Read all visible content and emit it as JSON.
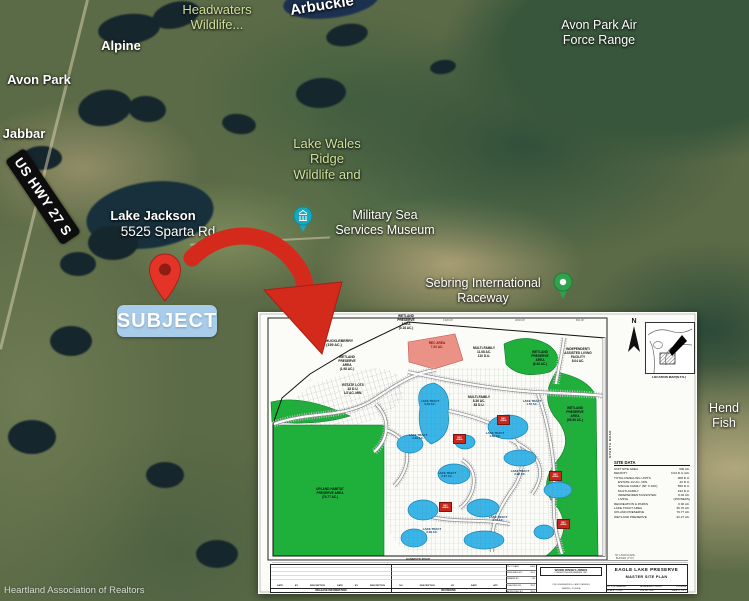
{
  "colors": {
    "arrow_red": "#d32a1c",
    "subject_badge_blue": "#a8cdeb",
    "preserve_green": "#1fb03c",
    "lake_blue": "#3ab5e8",
    "rec_salmon": "#eb9286",
    "museum_pin_teal": "#15aabf",
    "raceway_pin_green": "#2fa34c"
  },
  "map": {
    "subject_label": "SUBJECT",
    "highway_label": "US HWY 27 S",
    "watermark": "Heartland Association of Realtors",
    "labels": [
      {
        "text": "Headwaters\nWildlife...",
        "x": 217,
        "y": 2,
        "cls": "park"
      },
      {
        "text": "Alpine",
        "x": 121,
        "y": 38,
        "cls": "b"
      },
      {
        "text": "Avon Park",
        "x": 39,
        "y": 72,
        "cls": "b"
      },
      {
        "text": "Arbuckle",
        "x": 322,
        "y": -3,
        "cls": "big arb"
      },
      {
        "text": "Avon Park Air\nForce Range",
        "x": 599,
        "y": 18,
        "cls": ""
      },
      {
        "text": "Jabbar",
        "x": 24,
        "y": 126,
        "cls": "b"
      },
      {
        "text": "Lake Wales\nRidge\nWildlife and",
        "x": 327,
        "y": 136,
        "cls": "park"
      },
      {
        "text": "Military Sea\nServices Museum",
        "x": 385,
        "y": 208,
        "cls": ""
      },
      {
        "text": "Sebring International\nRaceway",
        "x": 483,
        "y": 276,
        "cls": ""
      },
      {
        "text": "Lake Jackson",
        "x": 153,
        "y": 208,
        "cls": "b"
      },
      {
        "text": "5525 Sparta Rd",
        "x": 168,
        "y": 224,
        "cls": "lg"
      },
      {
        "text": "Hend\nFish",
        "x": 724,
        "y": 401,
        "cls": ""
      }
    ]
  },
  "plan": {
    "north_label": "N",
    "location_map_caption": "LOCATION MAP(N.T.S.)",
    "sparta_road_label": "SPARTA ROAD",
    "hammock_road_label": "HAMMOCK ROAD",
    "parcel_labels": [
      {
        "text": "WETLAND\nPRESERVE\nAREA\n(0.18 AC.)",
        "x": 148,
        "y": 2,
        "cls": ""
      },
      {
        "text": "LAKE HUCKLEBERRY\n(159 AC.)",
        "x": 76,
        "y": 27,
        "cls": "bg"
      },
      {
        "text": "REC AREA\n7.20 AC.",
        "x": 179,
        "y": 29,
        "cls": "red"
      },
      {
        "text": "MULTI-FAMILY\n11.08 AC.\n110 D.U.",
        "x": 226,
        "y": 34,
        "cls": ""
      },
      {
        "text": "WETLAND\nPRESERVE\nAREA\n(6.36 AC.)",
        "x": 282,
        "y": 38,
        "cls": ""
      },
      {
        "text": "INDEPENDENT/\nASSISTED LIVING\nFACILITY\n8.04 AC.",
        "x": 320,
        "y": 35,
        "cls": ""
      },
      {
        "text": "WETLAND\nPRESERVE\nAREA\n(1.98 AC.)",
        "x": 89,
        "y": 43,
        "cls": ""
      },
      {
        "text": "ESTATE LOTS\n42 D.U.\n1/2 AC. MIN.",
        "x": 95,
        "y": 71,
        "cls": ""
      },
      {
        "text": "MULTI-FAMILY\n8.36 AC.\n83 D.U.",
        "x": 221,
        "y": 83,
        "cls": ""
      },
      {
        "text": "WETLAND\nPRESERVE\nAREA\n(39.56 AC.)",
        "x": 317,
        "y": 94,
        "cls": ""
      },
      {
        "text": "UPLAND HABITAT\nPRESERVE AREA\n(79.77 AC.)",
        "x": 72,
        "y": 175,
        "cls": ""
      },
      {
        "text": "50' LANDSCAPE\nBUFFER (TYP.)",
        "x": 367,
        "y": 242,
        "cls": "dim"
      }
    ],
    "dim_labels": [
      {
        "text": "1320.00'",
        "x": 190,
        "y": 7
      },
      {
        "text": "2640.00'",
        "x": 262,
        "y": 7
      },
      {
        "text": "660.00'",
        "x": 322,
        "y": 7
      }
    ],
    "lake_labels": [
      {
        "text": "LAKE TRACT\n9.49 AC.",
        "x": 172,
        "y": 88
      },
      {
        "text": "LAKE TRACT\n1.76 AC.",
        "x": 274,
        "y": 88
      },
      {
        "text": "LAKE TRACT\n2.19 AC.",
        "x": 160,
        "y": 122
      },
      {
        "text": "LAKE TRACT\n1.58 AC.",
        "x": 237,
        "y": 120
      },
      {
        "text": "LAKE TRACT\n2.67 AC.",
        "x": 189,
        "y": 160
      },
      {
        "text": "LAKE TRACT\n2.98 AC.",
        "x": 262,
        "y": 158
      },
      {
        "text": "LAKE TRACT\n2.09 AC.",
        "x": 174,
        "y": 216
      },
      {
        "text": "LAKE TRACT\n3.30 AC.",
        "x": 240,
        "y": 204
      }
    ],
    "rec_boxes": [
      {
        "text": "REC\nAREA",
        "x": 195,
        "y": 122
      },
      {
        "text": "REC\nAREA",
        "x": 239,
        "y": 103
      },
      {
        "text": "REC\nAREA",
        "x": 181,
        "y": 190
      },
      {
        "text": "REC\nAREA",
        "x": 291,
        "y": 159
      },
      {
        "text": "REC\nAREA",
        "x": 299,
        "y": 207
      }
    ],
    "site_data": {
      "header": "SITE DATA",
      "rows": [
        [
          "UNIT SITE AREA",
          "300 AC.",
          0
        ],
        [
          "DENSITY",
          "3.03 D.U./AC.",
          0
        ],
        [
          "TOTAL DWELLING UNITS",
          "908 D.U.",
          0
        ],
        [
          "ESTATE 1/2 AC. MIN.",
          "42 D.U.",
          1
        ],
        [
          "SINGLE FAMILY (50' X 100')",
          "550 D.U.",
          1
        ],
        [
          "MULTI-FAMILY",
          "193 D.U.",
          1
        ],
        [
          "INDEPENDENT/ASSISTED",
          "8.04 AC.",
          1
        ],
        [
          "LIVING",
          "(250 BEDS)",
          1
        ],
        [
          "RECREATION & PARKS",
          "9.30 AC.",
          0
        ],
        [
          "LAKE TRACT AREA",
          "36.70 AC.",
          0
        ],
        [
          "UPLAND PRESERVE",
          "79.77 AC.",
          0
        ],
        [
          "WETLAND PRESERVE",
          "42.27 AC.",
          0
        ]
      ]
    },
    "title_block": {
      "release_caption": "RELEASE INFORMATION",
      "release_headers": [
        "DATE",
        "BY",
        "DESCRIPTION",
        "DATE",
        "BY",
        "DESCRIPTION"
      ],
      "revisions_caption": "REVISIONS",
      "revision_headers": [
        "NO.",
        "DESCRIPTION",
        "BY",
        "DATE",
        "APP"
      ],
      "info_rows": [
        [
          "PLOT DATE",
          "2008"
        ],
        [
          "DESIGNED BY:",
          "WLJ"
        ],
        [
          "DRAWN BY:",
          "CM"
        ],
        [
          "CHECKED BY:",
          "WLJ"
        ],
        [
          "APPROVED BY:",
          "WLJ"
        ]
      ],
      "firm_name": "WOOD KINSEY-JONES",
      "firm_sub": "CONSULTING ENGINEERS, INC.",
      "firm_line1": "CIVIL ENGINEERING • LAND PLANNING",
      "firm_line2": "SEBRING, FLORIDA",
      "project_title": "EAGLE LAKE PRESERVE",
      "sheet_title": "MASTER SITE PLAN",
      "city": "CITY OF SEBRING",
      "county": "HIGHLANDS COUNTY",
      "state": "FLORIDA",
      "scale_label": "SCALE: 1\"=150'",
      "job_label": "JOB NO. 0637",
      "sheet_label": "SHEET 1 OF 1"
    }
  }
}
